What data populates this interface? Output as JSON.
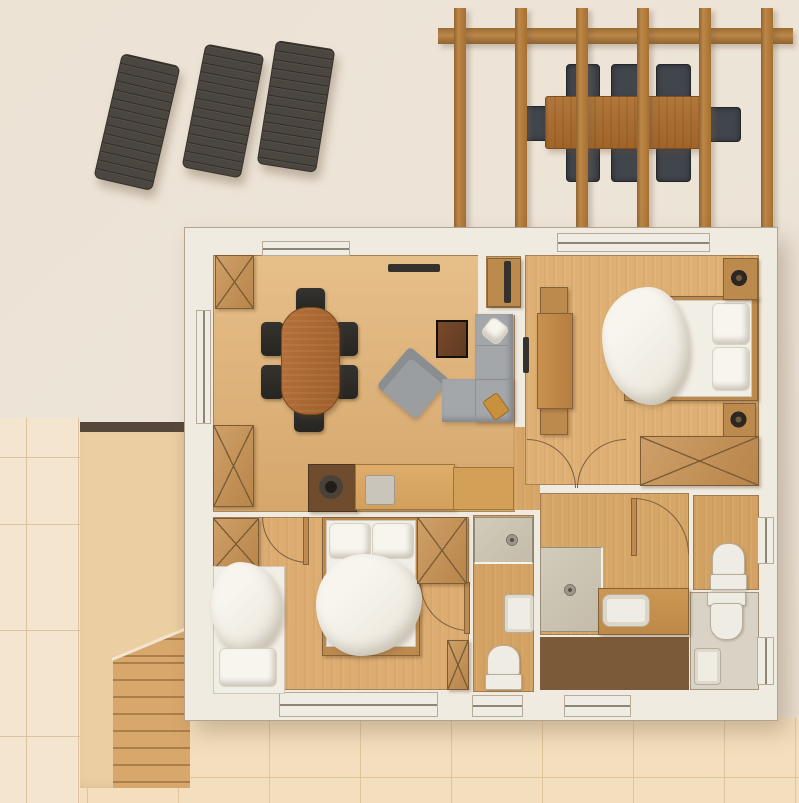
{
  "scene": {
    "kind": "3d-rendered apartment floor plan, top-down view",
    "visible_text": [],
    "outdoor": {
      "sun_loungers": {
        "count": 3,
        "color": "#4b463f"
      },
      "pergola": {
        "vertical_beams": 6,
        "horizontal_beams": 1,
        "wood_color": "#ad763c"
      },
      "outdoor_dining": {
        "table": 1,
        "chairs": 8,
        "table_color": "#a96f33",
        "chair_color": "#41454c"
      },
      "terraces": {
        "left_tiles_color": "#f4e6ce",
        "bottom_tiles_color": "#f3dfbd",
        "deck_platform_color": "#ebcfa3"
      },
      "stairs": {
        "treads": 9,
        "color": "#d8a76b"
      }
    },
    "house": {
      "wall_color": "#f0ebe1",
      "rooms": [
        {
          "name": "living-dining-room",
          "floor": "#deb074",
          "furniture": [
            "dining-table",
            "dining-chairs-x6",
            "wall-tv",
            "coffee-table",
            "armchair",
            "corner-sofa",
            "kitchen-counter",
            "sink-round",
            "cooktop-square",
            "wardrobe-x2"
          ]
        },
        {
          "name": "bedroom-master",
          "floor": "#deb074",
          "furniture": [
            "double-bed",
            "pillows-x2",
            "duvet",
            "nightstands-x2",
            "lamps-x2",
            "desk",
            "stools-x2",
            "wardrobe",
            "tv-cabinet",
            "wall-tv"
          ]
        },
        {
          "name": "bedroom-second",
          "floor": "#dcac70",
          "furniture": [
            "double-bed",
            "single-bed",
            "pillows",
            "wardrobe",
            "cabinets-x2"
          ]
        },
        {
          "name": "bathroom-small",
          "floor": "#d4a263",
          "furniture": [
            "shower",
            "washbasin",
            "toilet"
          ]
        },
        {
          "name": "bathroom-main",
          "floor": "#d6a667",
          "furniture": [
            "shower",
            "vanity-counter",
            "washbasin"
          ]
        },
        {
          "name": "sauna-storage",
          "floor": "#7b5a39",
          "furniture": []
        },
        {
          "name": "wc",
          "floor": "#d3a262",
          "furniture": [
            "toilet"
          ]
        },
        {
          "name": "bathroom-gray",
          "floor": "#d9d3c5",
          "furniture": [
            "toilet",
            "washbasin"
          ]
        }
      ],
      "doors": 5,
      "windows": 8
    },
    "palette": {
      "background": "#ece3d6",
      "wood_floor": "#deb074",
      "furniture_wood": "#c68f4f",
      "dining_table": "#ae6a33",
      "dark_chairs": "#2d2c29",
      "sofa_gray": "#a4a7aa",
      "bed_white": "#f1eee6",
      "dark_room": "#7b5a39",
      "shower_gray": "#cbc3b1"
    }
  }
}
